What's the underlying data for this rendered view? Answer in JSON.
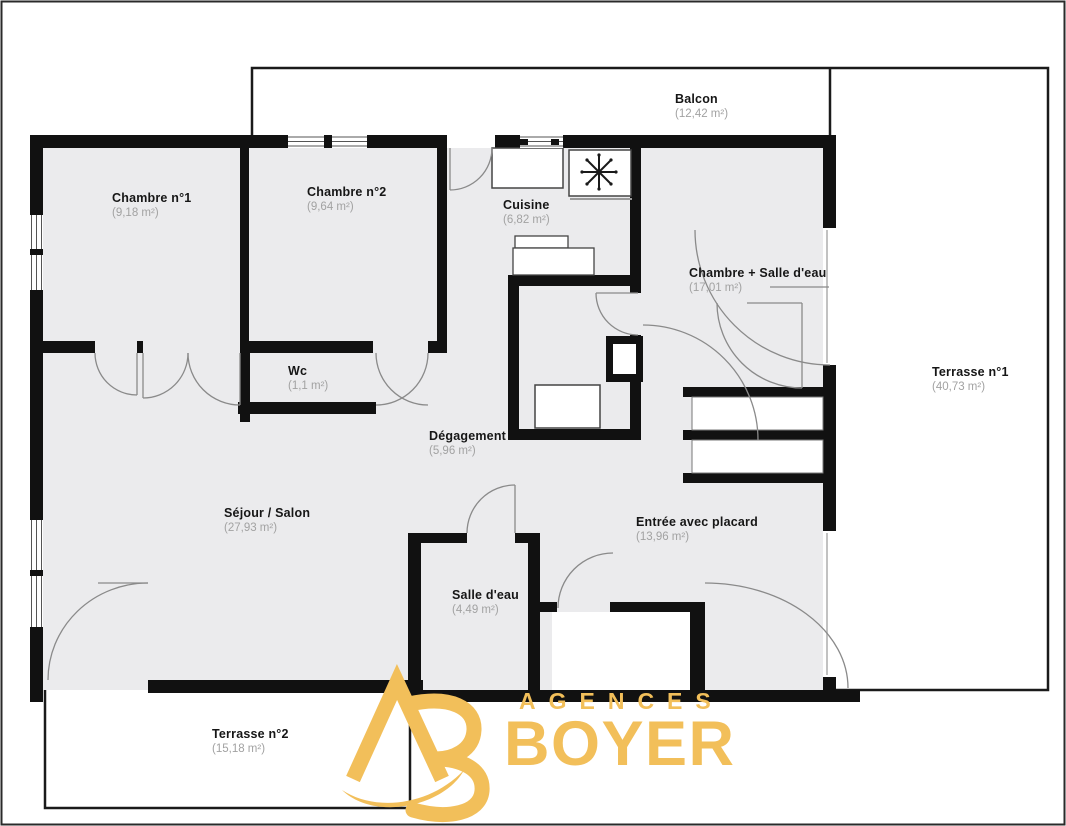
{
  "plan": {
    "rooms": [
      {
        "id": "balcon",
        "name": "Balcon",
        "area": "(12,42 m²)"
      },
      {
        "id": "chambre1",
        "name": "Chambre n°1",
        "area": "(9,18 m²)"
      },
      {
        "id": "chambre2",
        "name": "Chambre n°2",
        "area": "(9,64 m²)"
      },
      {
        "id": "cuisine",
        "name": "Cuisine",
        "area": "(6,82 m²)"
      },
      {
        "id": "chambre_salle_eau",
        "name": "Chambre + Salle d'eau",
        "area": "(17,01 m²)"
      },
      {
        "id": "terrasse1",
        "name": "Terrasse n°1",
        "area": "(40,73 m²)"
      },
      {
        "id": "wc",
        "name": "Wc",
        "area": "(1,1 m²)"
      },
      {
        "id": "degagement",
        "name": "Dégagement",
        "area": "(5,96 m²)"
      },
      {
        "id": "sejour",
        "name": "Séjour / Salon",
        "area": "(27,93 m²)"
      },
      {
        "id": "entree",
        "name": "Entrée avec placard",
        "area": "(13,96 m²)"
      },
      {
        "id": "salle_eau",
        "name": "Salle d'eau",
        "area": "(4,49 m²)"
      },
      {
        "id": "terrasse2",
        "name": "Terrasse n°2",
        "area": "(15,18 m²)"
      }
    ],
    "colors": {
      "wall": "#111111",
      "floor": "#ebebed",
      "door_arc": "#8a8a8a",
      "logo_gold": "#F2BF5A"
    }
  },
  "logo": {
    "monogram": "AB",
    "line1": "AGENCES",
    "line2": "BOYER"
  }
}
